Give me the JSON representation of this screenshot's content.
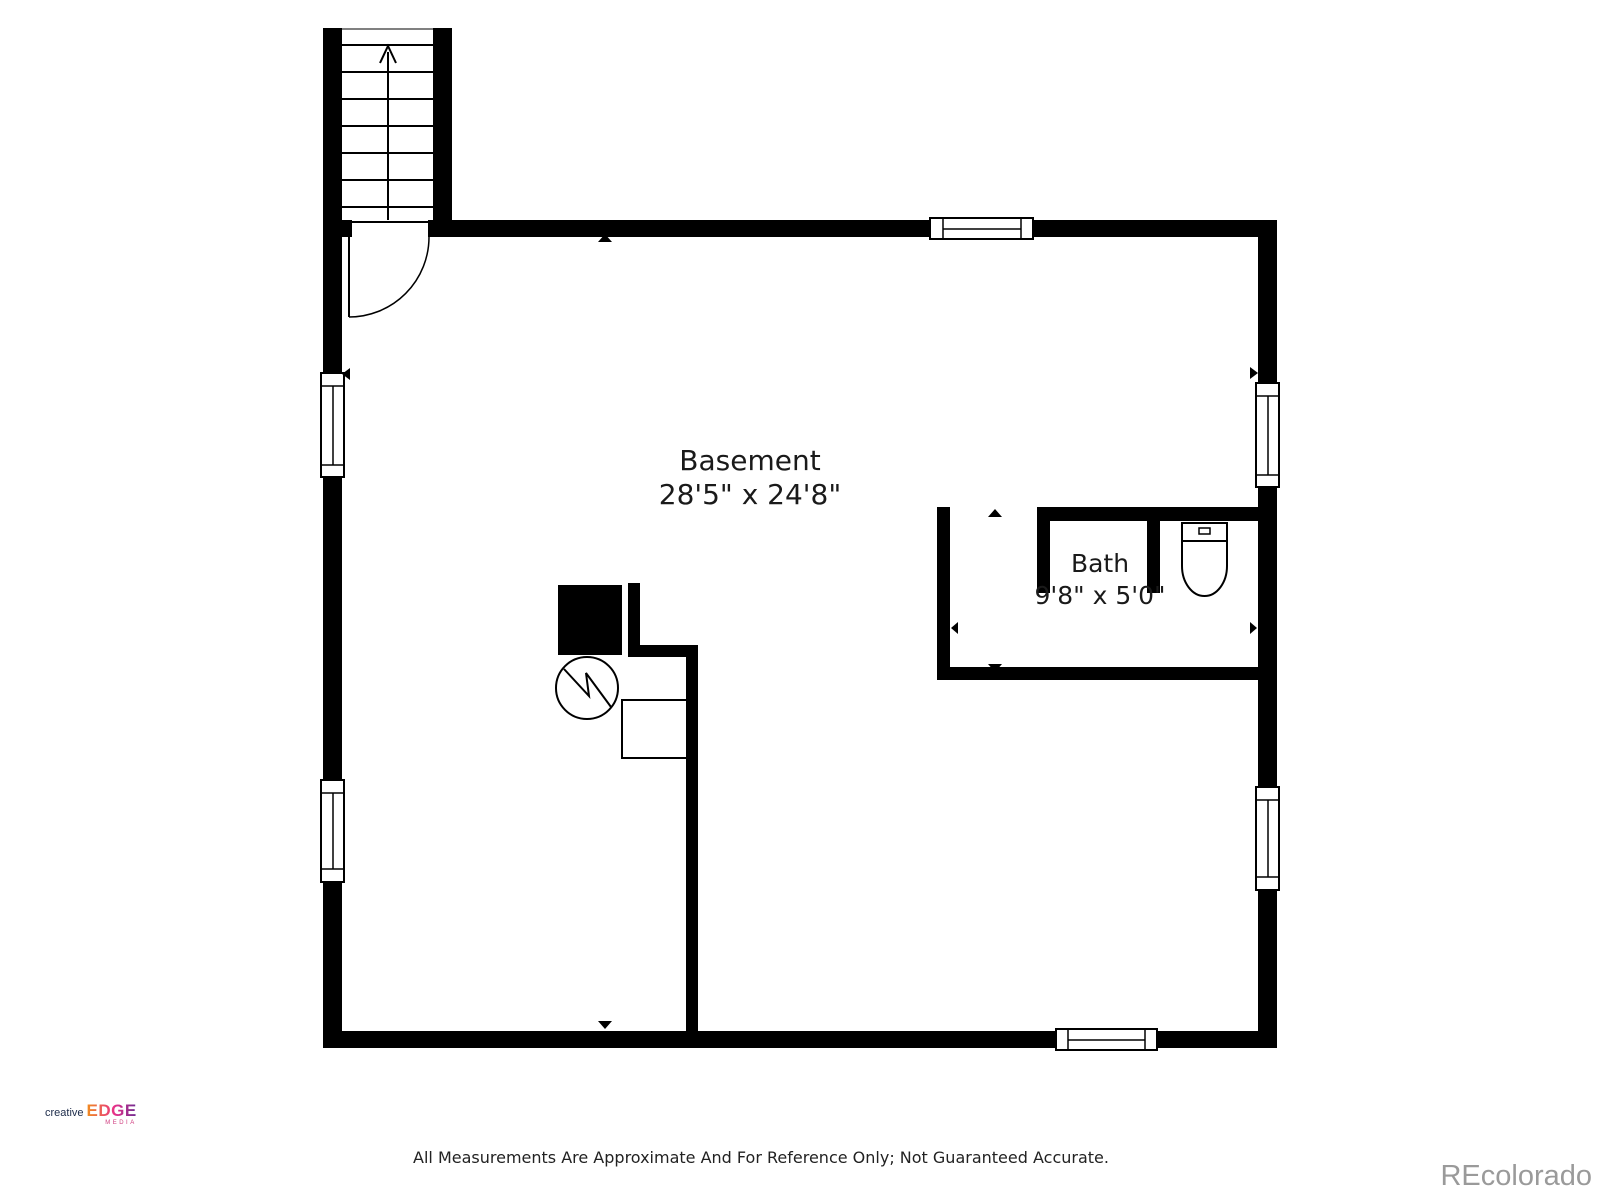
{
  "floor_plan": {
    "room_label": {
      "name": "Basement",
      "dimensions": "28'5\" x 24'8\""
    },
    "bath_label": {
      "name": "Bath",
      "dimensions": "9'8\" x 5'0\""
    },
    "symbols": [
      "staircase-up-arrow-icon",
      "door-swing-arc-icon",
      "window-icon",
      "toilet-icon",
      "water-heater-icon",
      "furnace-icon",
      "dimension-marker-icon"
    ],
    "colors": {
      "wall": "#000000",
      "floor": "#ffffff",
      "line": "#000000"
    }
  },
  "footer": {
    "logo": {
      "word_creative": "creative",
      "word_edge": "EDGE",
      "word_media": "MEDIA",
      "colors": {
        "creative": "#1c2b4a",
        "edge_gradient": [
          "#f08c1e",
          "#e8308a",
          "#6a2c91"
        ],
        "media": "#cf3a7d"
      }
    },
    "disclaimer": "All Measurements Are Approximate And For Reference Only; Not Guaranteed Accurate.",
    "watermark": {
      "text": "REcolorado",
      "color": "#9a9a9a"
    }
  }
}
